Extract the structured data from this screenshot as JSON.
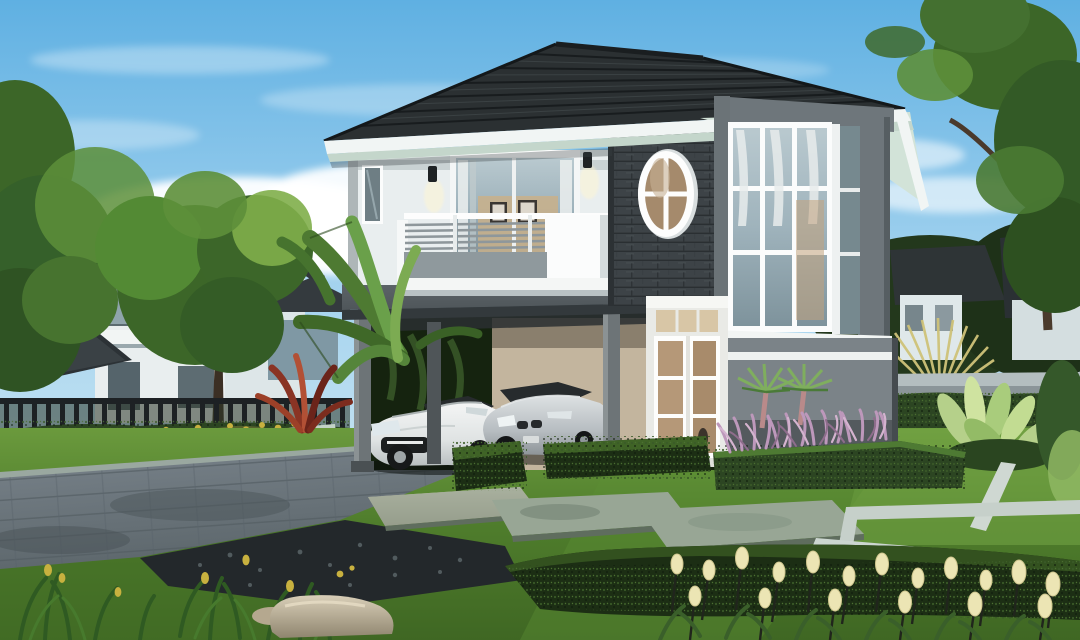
{
  "meta": {
    "type": "architectural-exterior-rendering",
    "subject": "Modern two-story house with glass corner bay, balcony, carport with two cars, and landscaped garden"
  },
  "colors": {
    "sky_top": "#5fb0e2",
    "sky_bottom": "#c3e2f2",
    "cloud": "#ffffff",
    "roof": "#2b3032",
    "roof_line": "#15191b",
    "fascia": "#f1f5f4",
    "soffit": "#d2e3d8",
    "wall_white": "#e9eeef",
    "wall_stone": "#3d4347",
    "wall_gray": "#7b8388",
    "wall_gray_dark": "#545a5e",
    "frame_gray": "#6e767b",
    "glass_cool": "#9fb3bc",
    "glass_warm": "#b59878",
    "curtain": "#e8ecec",
    "door_white": "#e9eae6",
    "beam": "#4f565a",
    "column": "#6d7477",
    "grass_light": "#6b9a3d",
    "grass_mid": "#4f7d2c",
    "grass_dark": "#3f6723",
    "hedge": "#2c4522",
    "hedge_dark": "#1c2e14",
    "tree": "#3c6628",
    "tree_light": "#5d8f3a",
    "driveway": "#6f797f",
    "pebble": "#23282b",
    "stone_slab": "#98a695",
    "curb": "#9fb2a4",
    "purple_grass": "#bd98bb",
    "cream_flower": "#ece5b4",
    "yellow_flower": "#c8b13f",
    "red_plant": "#8a3424",
    "fence": "#1d2124",
    "boundary_wall": "#8b9599",
    "gold_palm": "#cfc379",
    "car_white": "#eef0f0",
    "car_silver": "#c3c9cc",
    "car_glass": "#272b2d",
    "rock": "#c2b69e",
    "banana_leaf": "#5c8f3f",
    "bird_leaf": "#b5d08a"
  },
  "scene": {
    "objects": [
      "sky",
      "clouds",
      "left-neighbor-house",
      "left-trees",
      "metal-fence",
      "yellow-shrub-row",
      "main-house",
      "hip-roof",
      "balcony",
      "oval-window",
      "sliding-door",
      "wall-sconces",
      "glass-corner-bay",
      "front-door",
      "carport",
      "white-sports-car",
      "silver-sedan",
      "banana-leaves",
      "red-cordyline",
      "fan-palms",
      "purple-grass-bed",
      "boundary-wall",
      "golden-fan-palm",
      "right-tree",
      "bird-of-paradise-plants",
      "lawn",
      "driveway",
      "pebble-bed",
      "stepping-stones",
      "hedge-blocks",
      "foreground-hedge",
      "lawn-inlay-strips",
      "cream-tulips",
      "iris-plants",
      "boulder"
    ]
  }
}
